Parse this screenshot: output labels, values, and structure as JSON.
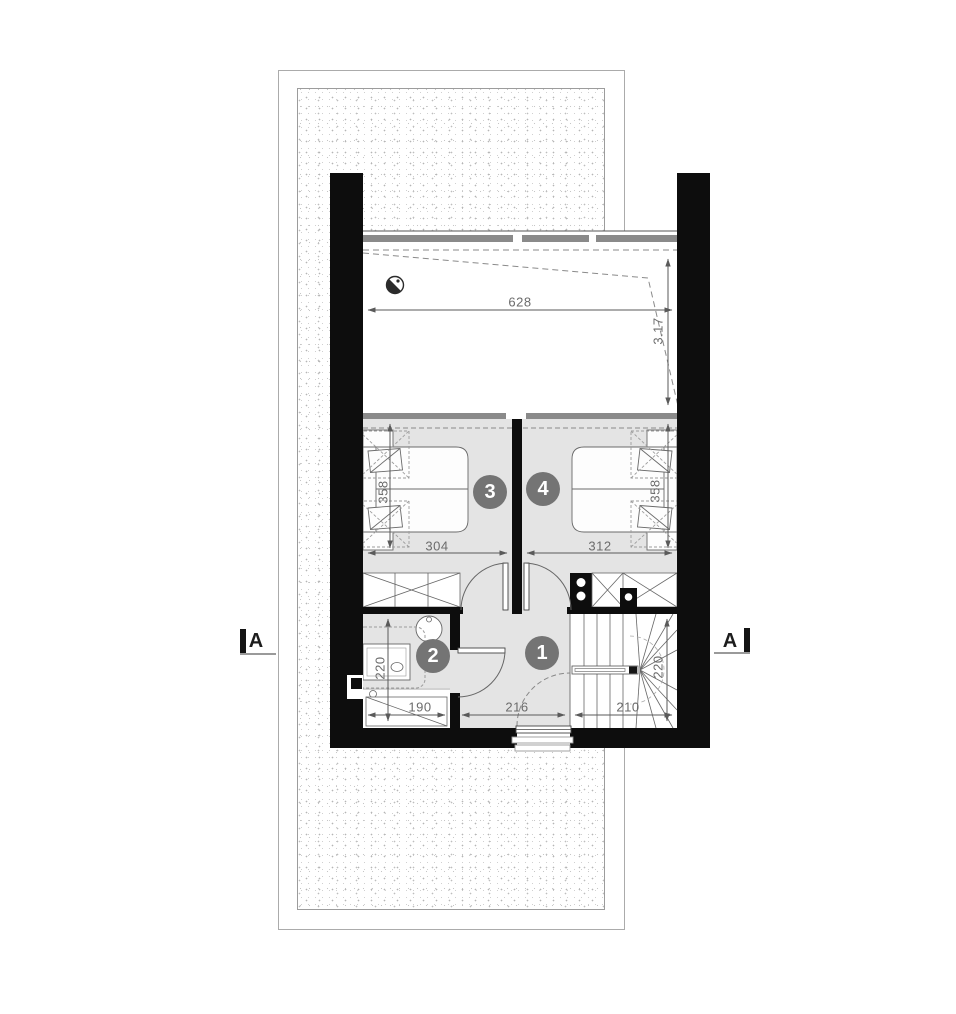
{
  "floor_plan": {
    "section_label_left": "A",
    "section_label_right": "A",
    "room_badges": [
      {
        "number": "1"
      },
      {
        "number": "2"
      },
      {
        "number": "3"
      },
      {
        "number": "4"
      }
    ],
    "dimensions": {
      "terrace_width": "628",
      "terrace_height": "3.17",
      "room3_depth": "358",
      "room3_width": "304",
      "room4_width": "312",
      "room4_depth": "358",
      "bathroom_depth": "220",
      "bathroom_width": "190",
      "hall_width": "216",
      "stairs_width": "210",
      "stairs_depth": "220"
    },
    "colors": {
      "wall": "#0d0d0d",
      "floor": "#e4e4e4",
      "badge": "#747474",
      "dimension_text": "#6b6b6b",
      "glazing": "#8a8a8a"
    }
  }
}
